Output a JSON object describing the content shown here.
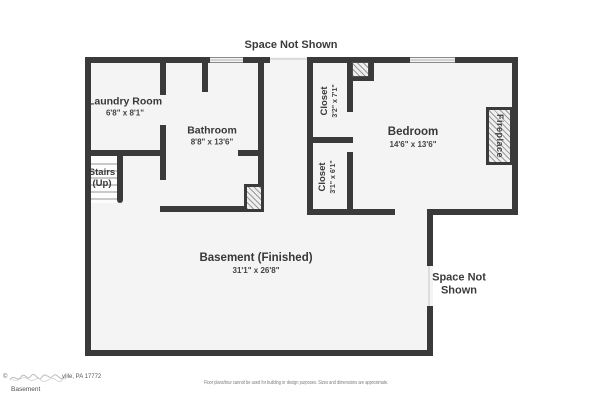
{
  "labels": {
    "space_not_shown_top": "Space Not Shown",
    "space_not_shown_right": "Space Not\nShown"
  },
  "rooms": {
    "laundry": {
      "name": "Laundry Room",
      "dims": "6'8\" x 8'1\""
    },
    "bathroom": {
      "name": "Bathroom",
      "dims": "8'8\" x 13'6\""
    },
    "closet_top": {
      "name": "Closet",
      "dims": "3'2\" x 7'1\""
    },
    "closet_bottom": {
      "name": "Closet",
      "dims": "3'1\" x 6'1\""
    },
    "bedroom": {
      "name": "Bedroom",
      "dims": "14'6\" x 13'6\""
    },
    "stairs": {
      "name": "Stairs",
      "sub": "(Up)"
    },
    "basement": {
      "name": "Basement (Finished)",
      "dims": "31'1\" x 26'8\""
    },
    "fireplace": {
      "name": "Fireplace"
    }
  },
  "footer": {
    "copyright_mark": "©",
    "address_tail": "ville, PA 17772",
    "floor_label": "Basement",
    "disclaimer": "Floor plans/tour cannot be used for building or design purposes. Sizes and dimensions are approximate."
  },
  "colors": {
    "wall": "#3a3a3a",
    "floor": "#f4f4f4",
    "text": "#383838",
    "background": "#ffffff"
  }
}
